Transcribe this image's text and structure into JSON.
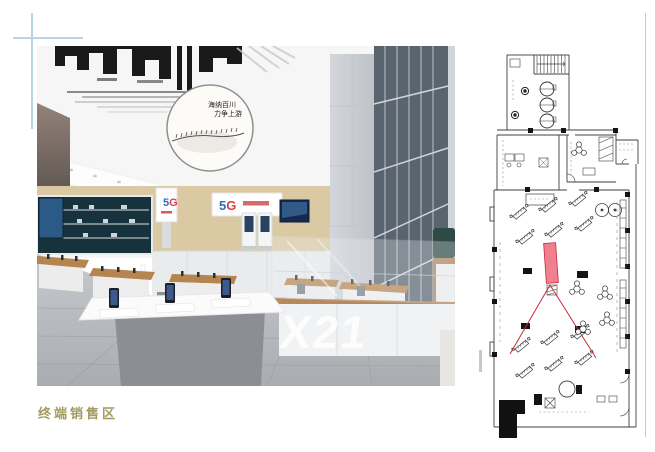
{
  "page": {
    "caption": "终端销售区"
  },
  "photo": {
    "medallion": {
      "line1": "海纳百川",
      "line2": "力争上游"
    },
    "logo": {
      "five": "5",
      "g": "G"
    },
    "foreground_model": "X21"
  },
  "floorplan": {
    "highlight_color": "#f0808e",
    "highlight_stroke": "#c72a3c",
    "leader_color": "#c72a3c"
  }
}
